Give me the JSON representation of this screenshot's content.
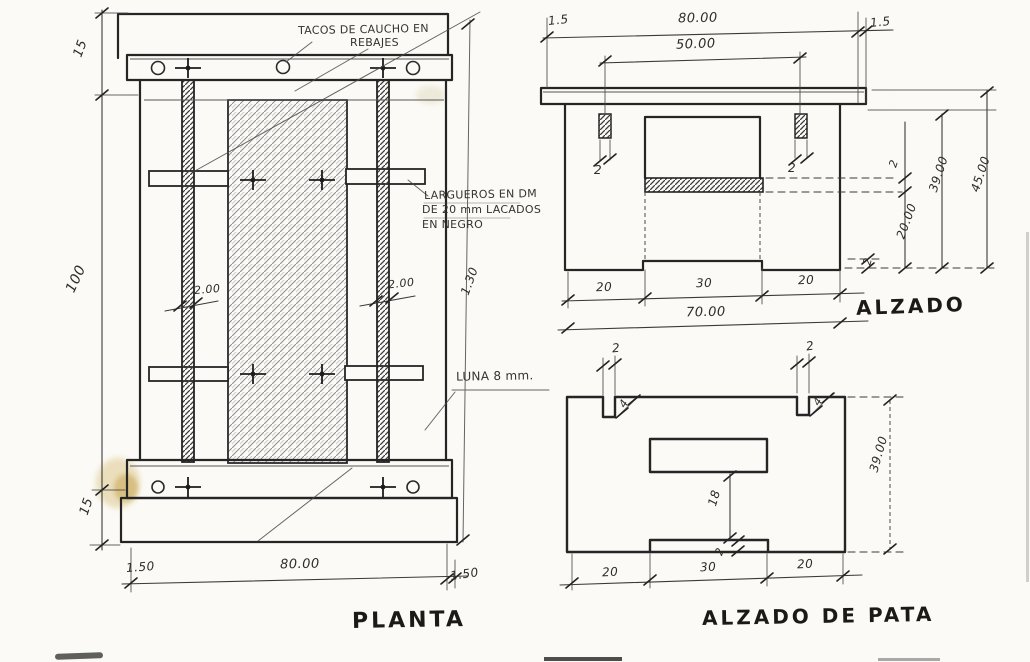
{
  "planta": {
    "title": "PLANTA",
    "note_tacos_line1": "TACOS DE CAUCHO EN",
    "note_tacos_line2": "REBAJES",
    "note_largueros_line1": "LARGUEROS EN DM",
    "note_largueros_line2": "DE 20 mm LACADOS",
    "note_largueros_line3": "EN NEGRO",
    "note_luna": "LUNA 8 mm.",
    "dim_end_top": "15",
    "dim_middle": "100",
    "dim_end_bottom": "15",
    "dim_overhang_left": "1.50",
    "dim_width": "80.00",
    "dim_overhang_right": "1.50",
    "dim_bar_left": "2.00",
    "dim_bar_right": "2.00",
    "dim_total_length": "1.30"
  },
  "alzado": {
    "title": "ALZADO",
    "dim_overhang_left": "1.5",
    "dim_width": "80.00",
    "dim_overhang_right": "1.5",
    "dim_inner_span": "50.00",
    "dim_tenon_left": "2",
    "dim_tenon_right": "2",
    "dim_leg_left": "20",
    "dim_span": "30",
    "dim_leg_right": "20",
    "dim_total_width": "70.00",
    "dim_stretcher_thickness": "2",
    "dim_panel_height": "39.00",
    "dim_total_height": "45.00",
    "dim_stretcher_height": "20.00",
    "dim_foot_step": "2"
  },
  "pata": {
    "title": "ALZADO DE PATA",
    "dim_notch_left": "2",
    "dim_notch_right": "2",
    "dim_notch_depth_left": "4",
    "dim_notch_depth_right": "4",
    "dim_window_height": "18",
    "dim_bottom_step": "2",
    "dim_height": "39.00",
    "dim_leg_left": "20",
    "dim_span": "30",
    "dim_leg_right": "20"
  }
}
